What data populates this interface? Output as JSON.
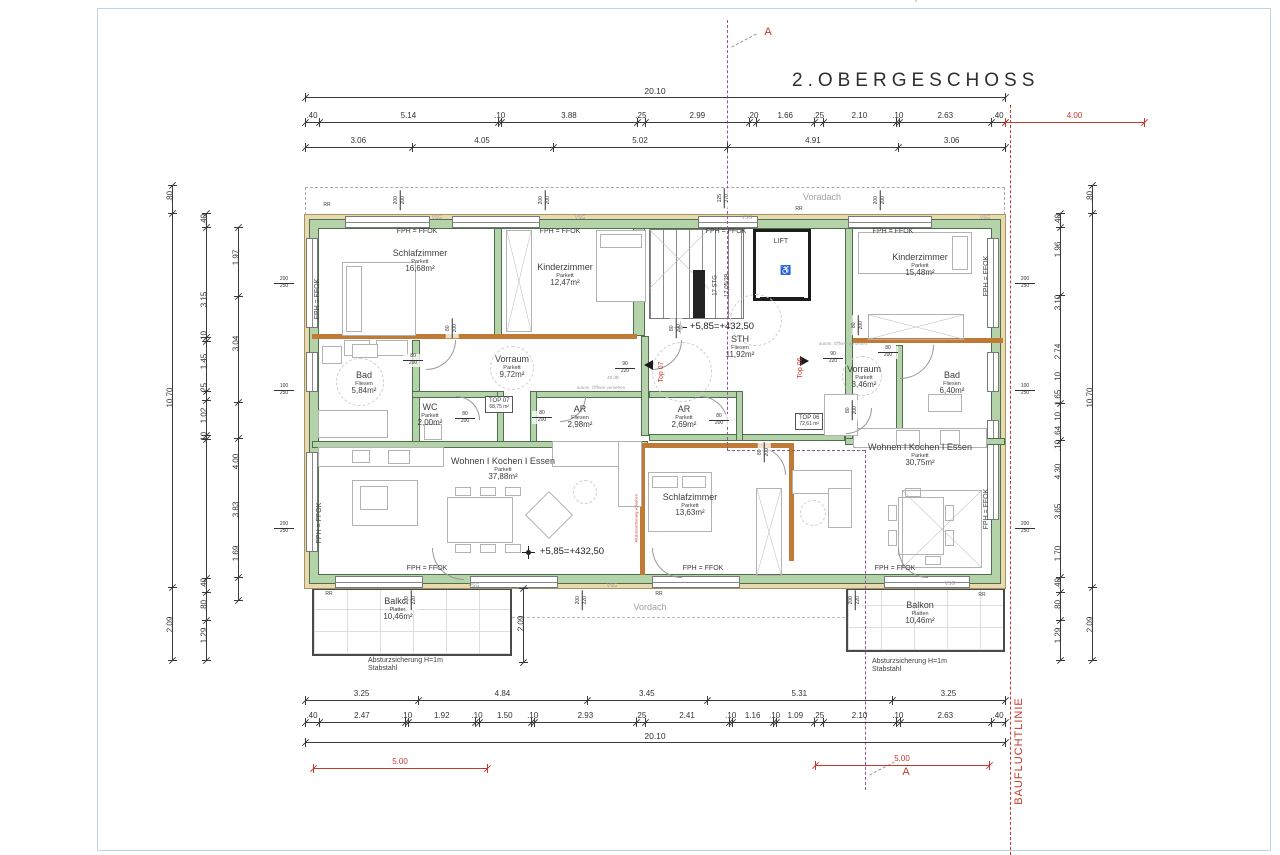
{
  "title": "2.OBERGESCHOSS",
  "red_line_label": "BAUFLUCHTLINIE",
  "rooms": [
    {
      "name": "Schlafzimmer",
      "floor": "Parkett",
      "area": "16,68m²",
      "x": 420,
      "y": 258
    },
    {
      "name": "Kinderzimmer",
      "floor": "Parkett",
      "area": "12,47m²",
      "x": 565,
      "y": 272
    },
    {
      "name": "Kinderzimmer",
      "floor": "Parkett",
      "area": "15,48m²",
      "x": 920,
      "y": 262
    },
    {
      "name": "Bad",
      "floor": "Fliesen",
      "area": "5,84m²",
      "x": 364,
      "y": 380
    },
    {
      "name": "Vorraum",
      "floor": "Parkett",
      "area": "9,72m²",
      "x": 512,
      "y": 364
    },
    {
      "name": "WC",
      "floor": "Parkett",
      "area": "2,00m²",
      "x": 430,
      "y": 412
    },
    {
      "name": "AR",
      "floor": "Fliesen",
      "area": "2,98m²",
      "x": 580,
      "y": 414
    },
    {
      "name": "STH",
      "floor": "Fliesen",
      "area": "11,92m²",
      "x": 740,
      "y": 344
    },
    {
      "name": "AR",
      "floor": "Parkett",
      "area": "2,69m²",
      "x": 684,
      "y": 414
    },
    {
      "name": "Vorraum",
      "floor": "Parkett",
      "area": "3,46m²",
      "x": 864,
      "y": 374
    },
    {
      "name": "Bad",
      "floor": "Fliesen",
      "area": "6,40m²",
      "x": 952,
      "y": 380
    },
    {
      "name": "Wohnen I Kochen I Essen",
      "floor": "Parkett",
      "area": "37,88m²",
      "x": 503,
      "y": 466
    },
    {
      "name": "Schlafzimmer",
      "floor": "Parkett",
      "area": "13,63m²",
      "x": 690,
      "y": 502
    },
    {
      "name": "Wohnen I Kochen I Essen",
      "floor": "Parkett",
      "area": "30,75m²",
      "x": 920,
      "y": 452
    },
    {
      "name": "Balkon",
      "floor": "Platten",
      "area": "10,46m²",
      "x": 398,
      "y": 606
    },
    {
      "name": "Balkon",
      "floor": "Platten",
      "area": "10,46m²",
      "x": 920,
      "y": 610
    }
  ],
  "unit_boxes": [
    {
      "name": "TOP 07",
      "area": "68,75 m²",
      "x": 507,
      "y": 405
    },
    {
      "name": "TOP 06",
      "area": "72,61 m²",
      "x": 817,
      "y": 422
    }
  ],
  "level_markers": [
    {
      "t": "+5,85=+432,50",
      "x": 722,
      "y": 327,
      "cx": 680
    },
    {
      "t": "+5,85=+432,50",
      "x": 572,
      "y": 552,
      "cx": 528
    }
  ],
  "annotations": [
    {
      "t": "FPH = FFOK",
      "x": 417,
      "y": 233,
      "s": 7
    },
    {
      "t": "FPH = FFOK",
      "x": 560,
      "y": 233,
      "s": 7
    },
    {
      "t": "FPH = FFOK",
      "x": 726,
      "y": 233,
      "s": 7
    },
    {
      "t": "FPH = FFOK",
      "x": 893,
      "y": 233,
      "s": 7
    },
    {
      "t": "FPH = FFOK",
      "x": 427,
      "y": 570,
      "s": 7
    },
    {
      "t": "FPH = FFOK",
      "x": 703,
      "y": 570,
      "s": 7
    },
    {
      "t": "FPH = FFOK",
      "x": 895,
      "y": 570,
      "s": 7
    },
    {
      "t": "FPH = FFOK",
      "x": 318,
      "y": 300,
      "s": 7,
      "r": -90
    },
    {
      "t": "FPH = FFOK",
      "x": 320,
      "y": 524,
      "s": 7,
      "r": -90
    },
    {
      "t": "FPH = FFOK",
      "x": 987,
      "y": 277,
      "s": 7,
      "r": -90
    },
    {
      "t": "FPH = FFOK",
      "x": 987,
      "y": 510,
      "s": 7,
      "r": -90
    },
    {
      "t": "RR",
      "x": 327,
      "y": 206,
      "s": 5
    },
    {
      "t": "RR",
      "x": 799,
      "y": 210,
      "s": 5
    },
    {
      "t": "RR",
      "x": 329,
      "y": 595,
      "s": 5
    },
    {
      "t": "RR",
      "x": 659,
      "y": 595,
      "s": 5
    },
    {
      "t": "RR",
      "x": 982,
      "y": 596,
      "s": 5
    },
    {
      "t": "VSG",
      "x": 437,
      "y": 219,
      "s": 5,
      "c": "gray"
    },
    {
      "t": "VSG",
      "x": 580,
      "y": 219,
      "s": 5,
      "c": "gray"
    },
    {
      "t": "VSG",
      "x": 747,
      "y": 219,
      "s": 5,
      "c": "gray"
    },
    {
      "t": "VSG",
      "x": 985,
      "y": 219,
      "s": 5,
      "c": "gray"
    },
    {
      "t": "VSG",
      "x": 474,
      "y": 587,
      "s": 5,
      "c": "gray"
    },
    {
      "t": "VSG",
      "x": 612,
      "y": 587,
      "s": 5,
      "c": "gray"
    },
    {
      "t": "VSG",
      "x": 950,
      "y": 585,
      "s": 5,
      "c": "gray"
    },
    {
      "t": "LIFT",
      "x": 781,
      "y": 243,
      "s": 7
    },
    {
      "t": "♿",
      "x": 786,
      "y": 271,
      "s": 9
    },
    {
      "t": "17 STG",
      "x": 716,
      "y": 286,
      "s": 6,
      "r": -90
    },
    {
      "t": "17,05/29",
      "x": 728,
      "y": 286,
      "s": 6,
      "r": -90
    },
    {
      "t": "40 dB",
      "x": 613,
      "y": 378,
      "s": 4.5,
      "c": "gray"
    },
    {
      "t": "autom. Öffnen vorsehen",
      "x": 601,
      "y": 388,
      "s": 4.5,
      "c": "gray"
    },
    {
      "t": "autom. Öffnen vorsehen",
      "x": 843,
      "y": 344,
      "s": 4.5,
      "c": "gray"
    },
    {
      "t": "Voradach",
      "x": 822,
      "y": 198,
      "s": 9,
      "c": "gray"
    },
    {
      "t": "Vordach",
      "x": 650,
      "y": 608,
      "s": 9,
      "c": "gray"
    },
    {
      "t": "Absturzsicherung  H=1m\nStabstahl",
      "x": 368,
      "y": 657,
      "s": 7,
      "a": "l"
    },
    {
      "t": "Absturzsicherung  H=1m\nStabstahl",
      "x": 872,
      "y": 658,
      "s": 7,
      "a": "l"
    },
    {
      "t": "Top 07",
      "x": 662,
      "y": 373,
      "s": 7,
      "c": "red",
      "r": -90
    },
    {
      "t": "Top 06",
      "x": 801,
      "y": 369,
      "s": 7,
      "c": "red",
      "r": -90
    },
    {
      "t": "A",
      "x": 768,
      "y": 34,
      "s": 11,
      "c": "red"
    },
    {
      "t": "A",
      "x": 906,
      "y": 774,
      "s": 11,
      "c": "red"
    },
    {
      "t": "Absturzsicherung vorsehen",
      "x": 637,
      "y": 519,
      "s": 4,
      "c": "red",
      "r": -90
    }
  ],
  "fractions": [
    {
      "n": "80",
      "d": "200",
      "x": 413,
      "y": 360
    },
    {
      "n": "80",
      "d": "200",
      "x": 465,
      "y": 418
    },
    {
      "n": "80",
      "d": "200",
      "x": 542,
      "y": 417
    },
    {
      "n": "80",
      "d": "200",
      "x": 719,
      "y": 420
    },
    {
      "n": "90",
      "d": "220",
      "x": 625,
      "y": 368
    },
    {
      "n": "90",
      "d": "220",
      "x": 833,
      "y": 358
    },
    {
      "n": "80",
      "d": "200",
      "x": 888,
      "y": 352
    },
    {
      "n": "80",
      "d": "200",
      "x": 452,
      "y": 328,
      "r": -90
    },
    {
      "n": "80",
      "d": "200",
      "x": 676,
      "y": 328,
      "r": -90
    },
    {
      "n": "80",
      "d": "200",
      "x": 858,
      "y": 325,
      "r": -90
    },
    {
      "n": "80",
      "d": "200",
      "x": 852,
      "y": 410,
      "r": -90
    },
    {
      "n": "80",
      "d": "200",
      "x": 764,
      "y": 452,
      "r": -90
    },
    {
      "n": "200",
      "d": "250",
      "x": 284,
      "y": 283
    },
    {
      "n": "100",
      "d": "250",
      "x": 284,
      "y": 390
    },
    {
      "n": "200",
      "d": "250",
      "x": 284,
      "y": 528
    },
    {
      "n": "200",
      "d": "250",
      "x": 1025,
      "y": 283
    },
    {
      "n": "100",
      "d": "250",
      "x": 1025,
      "y": 390
    },
    {
      "n": "200",
      "d": "250",
      "x": 1025,
      "y": 528
    },
    {
      "n": "200",
      "d": "200",
      "x": 400,
      "y": 200,
      "r": -90
    },
    {
      "n": "200",
      "d": "200",
      "x": 545,
      "y": 200,
      "r": -90
    },
    {
      "n": "125",
      "d": "270",
      "x": 724,
      "y": 198,
      "r": -90
    },
    {
      "n": "200",
      "d": "200",
      "x": 880,
      "y": 200,
      "r": -90
    },
    {
      "n": "200",
      "d": "220",
      "x": 411,
      "y": 600,
      "r": -90
    },
    {
      "n": "200",
      "d": "220",
      "x": 582,
      "y": 600,
      "r": -90
    },
    {
      "n": "200",
      "d": "220",
      "x": 855,
      "y": 600,
      "r": -90
    }
  ],
  "dims_h": [
    {
      "y": 97,
      "x1": 305,
      "x2": 1005,
      "vals": [
        "20.10"
      ],
      "overall": true
    },
    {
      "y": 122,
      "x1": 305,
      "x2": 1005,
      "vals": [
        ".40",
        "5.14",
        ".10",
        "3.88",
        ".25",
        "2.99",
        ".20",
        "1.66",
        ".25",
        "2.10",
        ".10",
        "2.63",
        ".40"
      ]
    },
    {
      "y": 147,
      "x1": 305,
      "x2": 1005,
      "vals": [
        "3.06",
        "4.05",
        "5.02",
        "4.91",
        "3.06"
      ]
    },
    {
      "y": 700,
      "x1": 305,
      "x2": 1005,
      "vals": [
        "3.25",
        "4.84",
        "3.45",
        "5.31",
        "3.25"
      ]
    },
    {
      "y": 722,
      "x1": 305,
      "x2": 1005,
      "vals": [
        ".40",
        "2.47",
        ".10",
        "1.92",
        ".10",
        "1.50",
        ".10",
        "2.93",
        ".25",
        "2.41",
        ".10",
        "1.16",
        ".10",
        "1.09",
        ".25",
        "2.10",
        ".10",
        "2.63",
        ".40"
      ]
    },
    {
      "y": 742,
      "x1": 305,
      "x2": 1005,
      "vals": [
        "20.10"
      ],
      "overall": true
    }
  ],
  "dims_red": [
    {
      "y": 122,
      "x1": 1005,
      "x2": 1144,
      "t": "4.00"
    },
    {
      "y": 768,
      "x1": 313,
      "x2": 487,
      "t": "5.00"
    },
    {
      "y": 765,
      "x1": 815,
      "x2": 989,
      "t": "5.00"
    }
  ],
  "dims_v": [
    {
      "x": 172,
      "y1": 185,
      "y2": 660,
      "ticks": [
        185,
        213,
        587,
        660
      ],
      "labels": [
        {
          "t": ".80",
          "y": 197
        },
        {
          "t": "10.70",
          "y": 398
        },
        {
          "t": "2.09",
          "y": 625
        }
      ]
    },
    {
      "x": 206,
      "y1": 213,
      "y2": 660,
      "ticks": [
        213,
        227,
        337,
        341,
        391,
        400,
        435,
        439,
        578,
        592,
        620,
        660
      ],
      "labels": [
        {
          "t": ".40",
          "y": 220
        },
        {
          "t": "3.15",
          "y": 300
        },
        {
          "t": ".10",
          "y": 337
        },
        {
          "t": "1.45",
          "y": 362
        },
        {
          "t": ".25",
          "y": 389
        },
        {
          "t": "1.02",
          "y": 416
        },
        {
          "t": ".10",
          "y": 438
        },
        {
          "t": ".40",
          "y": 584
        },
        {
          "t": ".80",
          "y": 606
        },
        {
          "t": "1.29",
          "y": 636
        }
      ]
    },
    {
      "x": 238,
      "y1": 227,
      "y2": 600,
      "ticks": [
        227,
        296,
        402,
        438,
        577,
        600
      ],
      "labels": [
        {
          "t": "1.97",
          "y": 258
        },
        {
          "t": "3.04",
          "y": 344
        },
        {
          "t": "4.00",
          "y": 462
        },
        {
          "t": "3.83",
          "y": 510
        },
        {
          "t": "1.69",
          "y": 554
        }
      ]
    },
    {
      "x": 523,
      "y1": 588,
      "y2": 662,
      "ticks": [
        588,
        662
      ],
      "labels": [
        {
          "t": "2.09",
          "y": 624
        }
      ]
    },
    {
      "x": 1060,
      "y1": 213,
      "y2": 660,
      "ticks": [
        213,
        227,
        295,
        403,
        440,
        577,
        592,
        620,
        660
      ],
      "labels": [
        {
          "t": ".40",
          "y": 220
        },
        {
          "t": "1.96",
          "y": 250
        },
        {
          "t": "3.10",
          "y": 303
        },
        {
          "t": "2.74",
          "y": 352
        },
        {
          "t": ".10",
          "y": 378
        },
        {
          "t": "1.65",
          "y": 398
        },
        {
          "t": ".10",
          "y": 418
        },
        {
          "t": ".64",
          "y": 432
        },
        {
          "t": ".10",
          "y": 446
        },
        {
          "t": "4.30",
          "y": 472
        },
        {
          "t": "3.65",
          "y": 512
        },
        {
          "t": "1.70",
          "y": 554
        },
        {
          "t": ".40",
          "y": 584
        },
        {
          "t": ".80",
          "y": 606
        },
        {
          "t": "1.29",
          "y": 636
        }
      ]
    },
    {
      "x": 1092,
      "y1": 185,
      "y2": 660,
      "ticks": [
        185,
        213,
        587,
        660
      ],
      "labels": [
        {
          "t": ".80",
          "y": 197
        },
        {
          "t": "10.70",
          "y": 398
        },
        {
          "t": "2.09",
          "y": 625
        }
      ]
    }
  ]
}
